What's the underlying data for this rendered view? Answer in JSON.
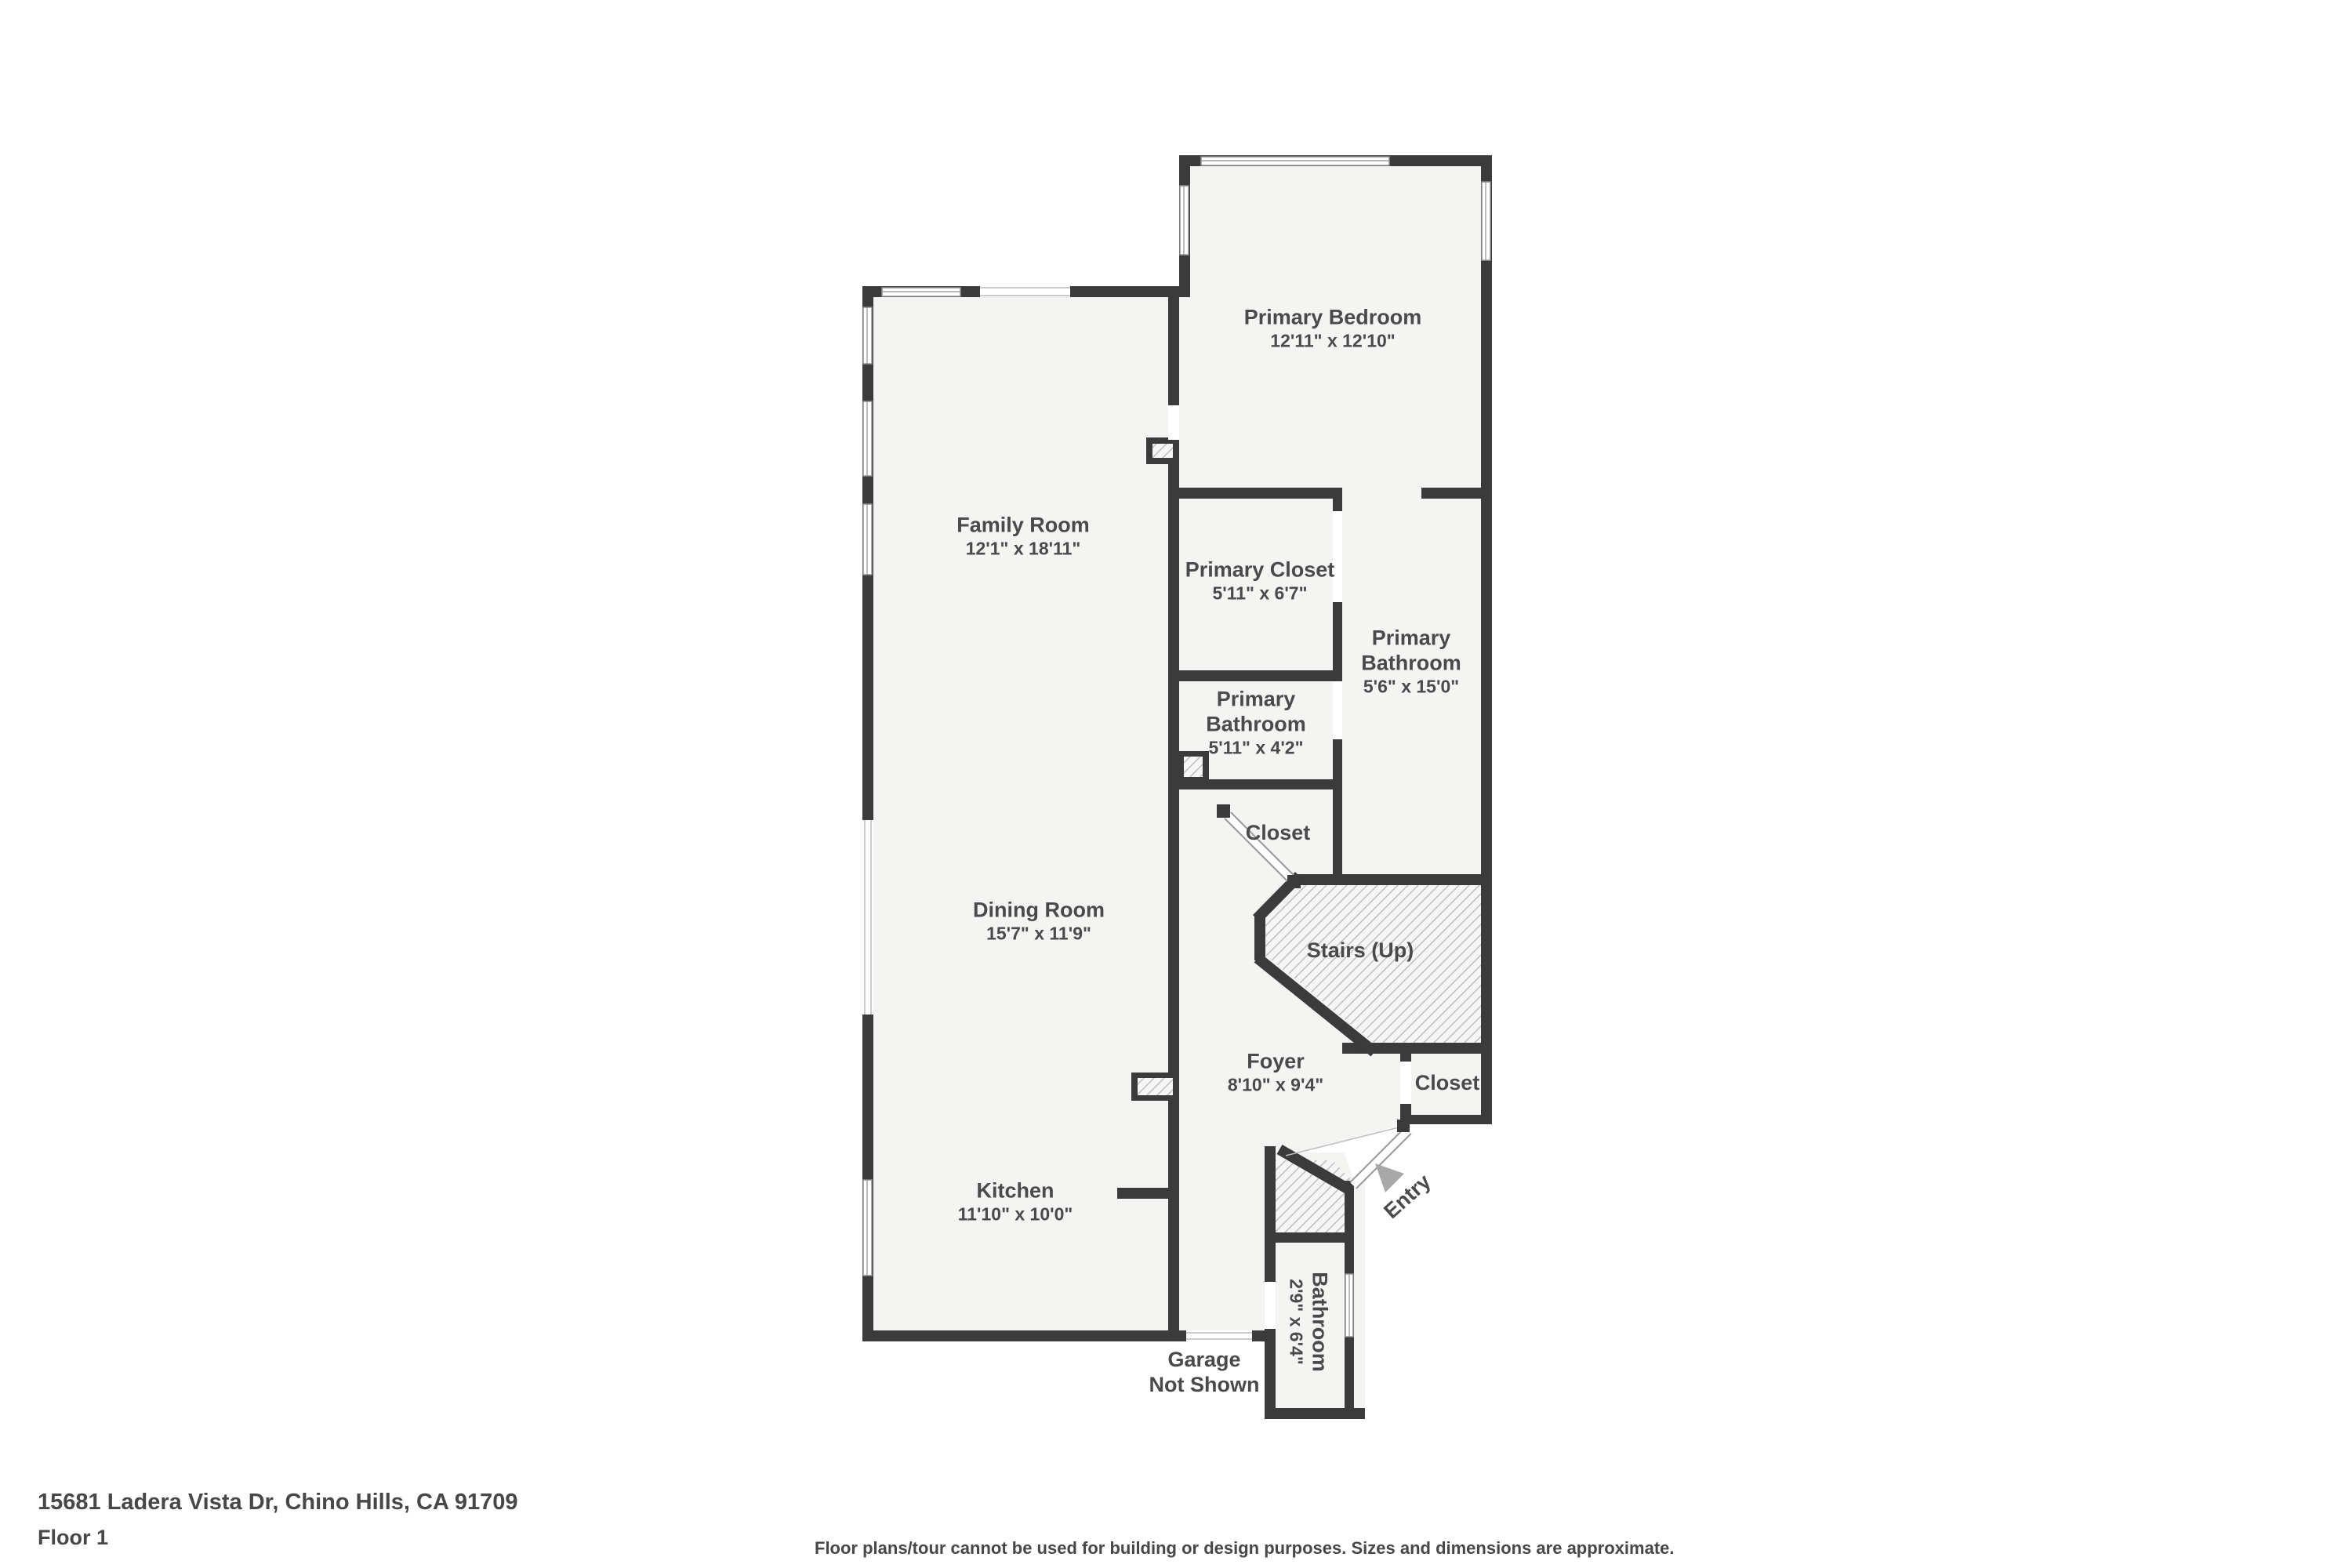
{
  "palette": {
    "wall": "#3b3b3b",
    "floor": "#f4f4f2",
    "hatch_line": "#c2c2c2",
    "window_line": "#8f8f8f",
    "label_text": "#4a4a4a",
    "entry_arrow": "#a8a8a8",
    "background": "#ffffff"
  },
  "rooms": {
    "primary_bedroom": {
      "name": "Primary Bedroom",
      "dims": "12'11\" x 12'10\""
    },
    "family_room": {
      "name": "Family Room",
      "dims": "12'1\" x 18'11\""
    },
    "primary_closet": {
      "name": "Primary Closet",
      "dims": "5'11\" x 6'7\""
    },
    "primary_bathroom_large": {
      "name_line1": "Primary",
      "name_line2": "Bathroom",
      "dims": "5'6\" x 15'0\""
    },
    "primary_bathroom_small": {
      "name_line1": "Primary",
      "name_line2": "Bathroom",
      "dims": "5'11\" x 4'2\""
    },
    "hall_closet": {
      "name": "Closet"
    },
    "dining_room": {
      "name": "Dining Room",
      "dims": "15'7\" x 11'9\""
    },
    "stairs": {
      "name": "Stairs (Up)"
    },
    "foyer": {
      "name": "Foyer",
      "dims": "8'10\" x 9'4\""
    },
    "entry_closet": {
      "name": "Closet"
    },
    "kitchen": {
      "name": "Kitchen",
      "dims": "11'10\" x 10'0\""
    },
    "entry": {
      "name": "Entry"
    },
    "bathroom": {
      "name": "Bathroom",
      "dims": "2'9\" x 6'4\""
    },
    "garage_note": {
      "line1": "Garage",
      "line2": "Not Shown"
    }
  },
  "footer": {
    "address": "15681 Ladera Vista Dr, Chino Hills, CA 91709",
    "floor_label": "Floor 1",
    "disclaimer": "Floor plans/tour cannot be used for building or design purposes. Sizes and dimensions are approximate."
  }
}
